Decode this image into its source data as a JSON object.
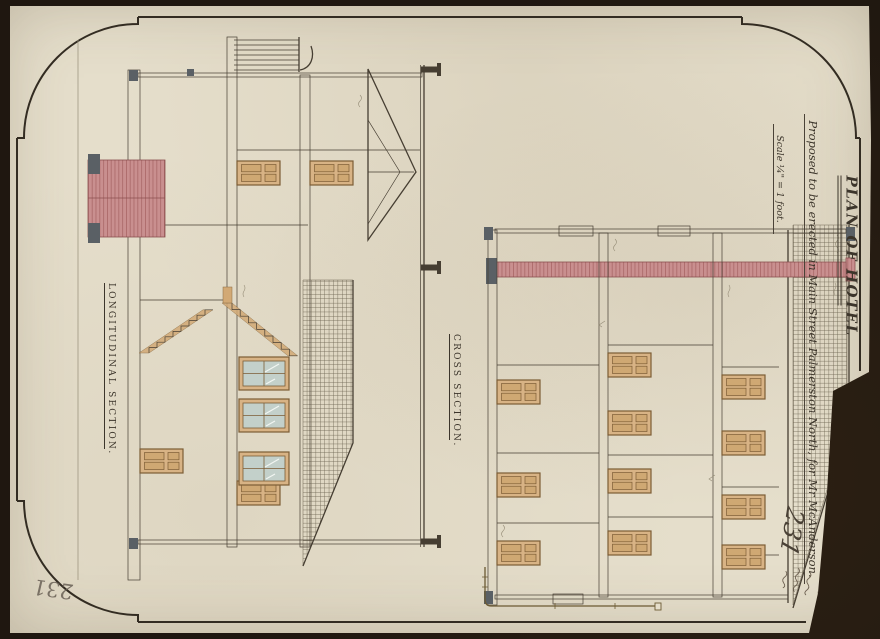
{
  "sheet": {
    "title": "PLAN OF HOTEL",
    "subtitle": "Proposed to be erected in Main Street Palmerston North, for Mr McAnderson.",
    "scale_note": "Scale ¼\" = 1 foot.",
    "section_labels": {
      "longitudinal": "LONGITUDINAL SECTION.",
      "cross": "CROSS SECTION."
    },
    "sheet_number": "231",
    "sheet_number_reverse": "231",
    "signature": "illegible handwritten signature, three short cursive lines",
    "pencil_notes": "tiny illegible pencil annotations beside roof, floor and chimney lines",
    "colors": {
      "paper": "#e5decb",
      "backing": "#241a11",
      "ink": "#463e32",
      "wash_tan_joinery": "#d8b385",
      "wash_pink_brick": "#c98f8f",
      "wash_blue_glass": "#c3d0ca",
      "slate_gray": "#5a6065",
      "pencil": "#968d78"
    }
  }
}
